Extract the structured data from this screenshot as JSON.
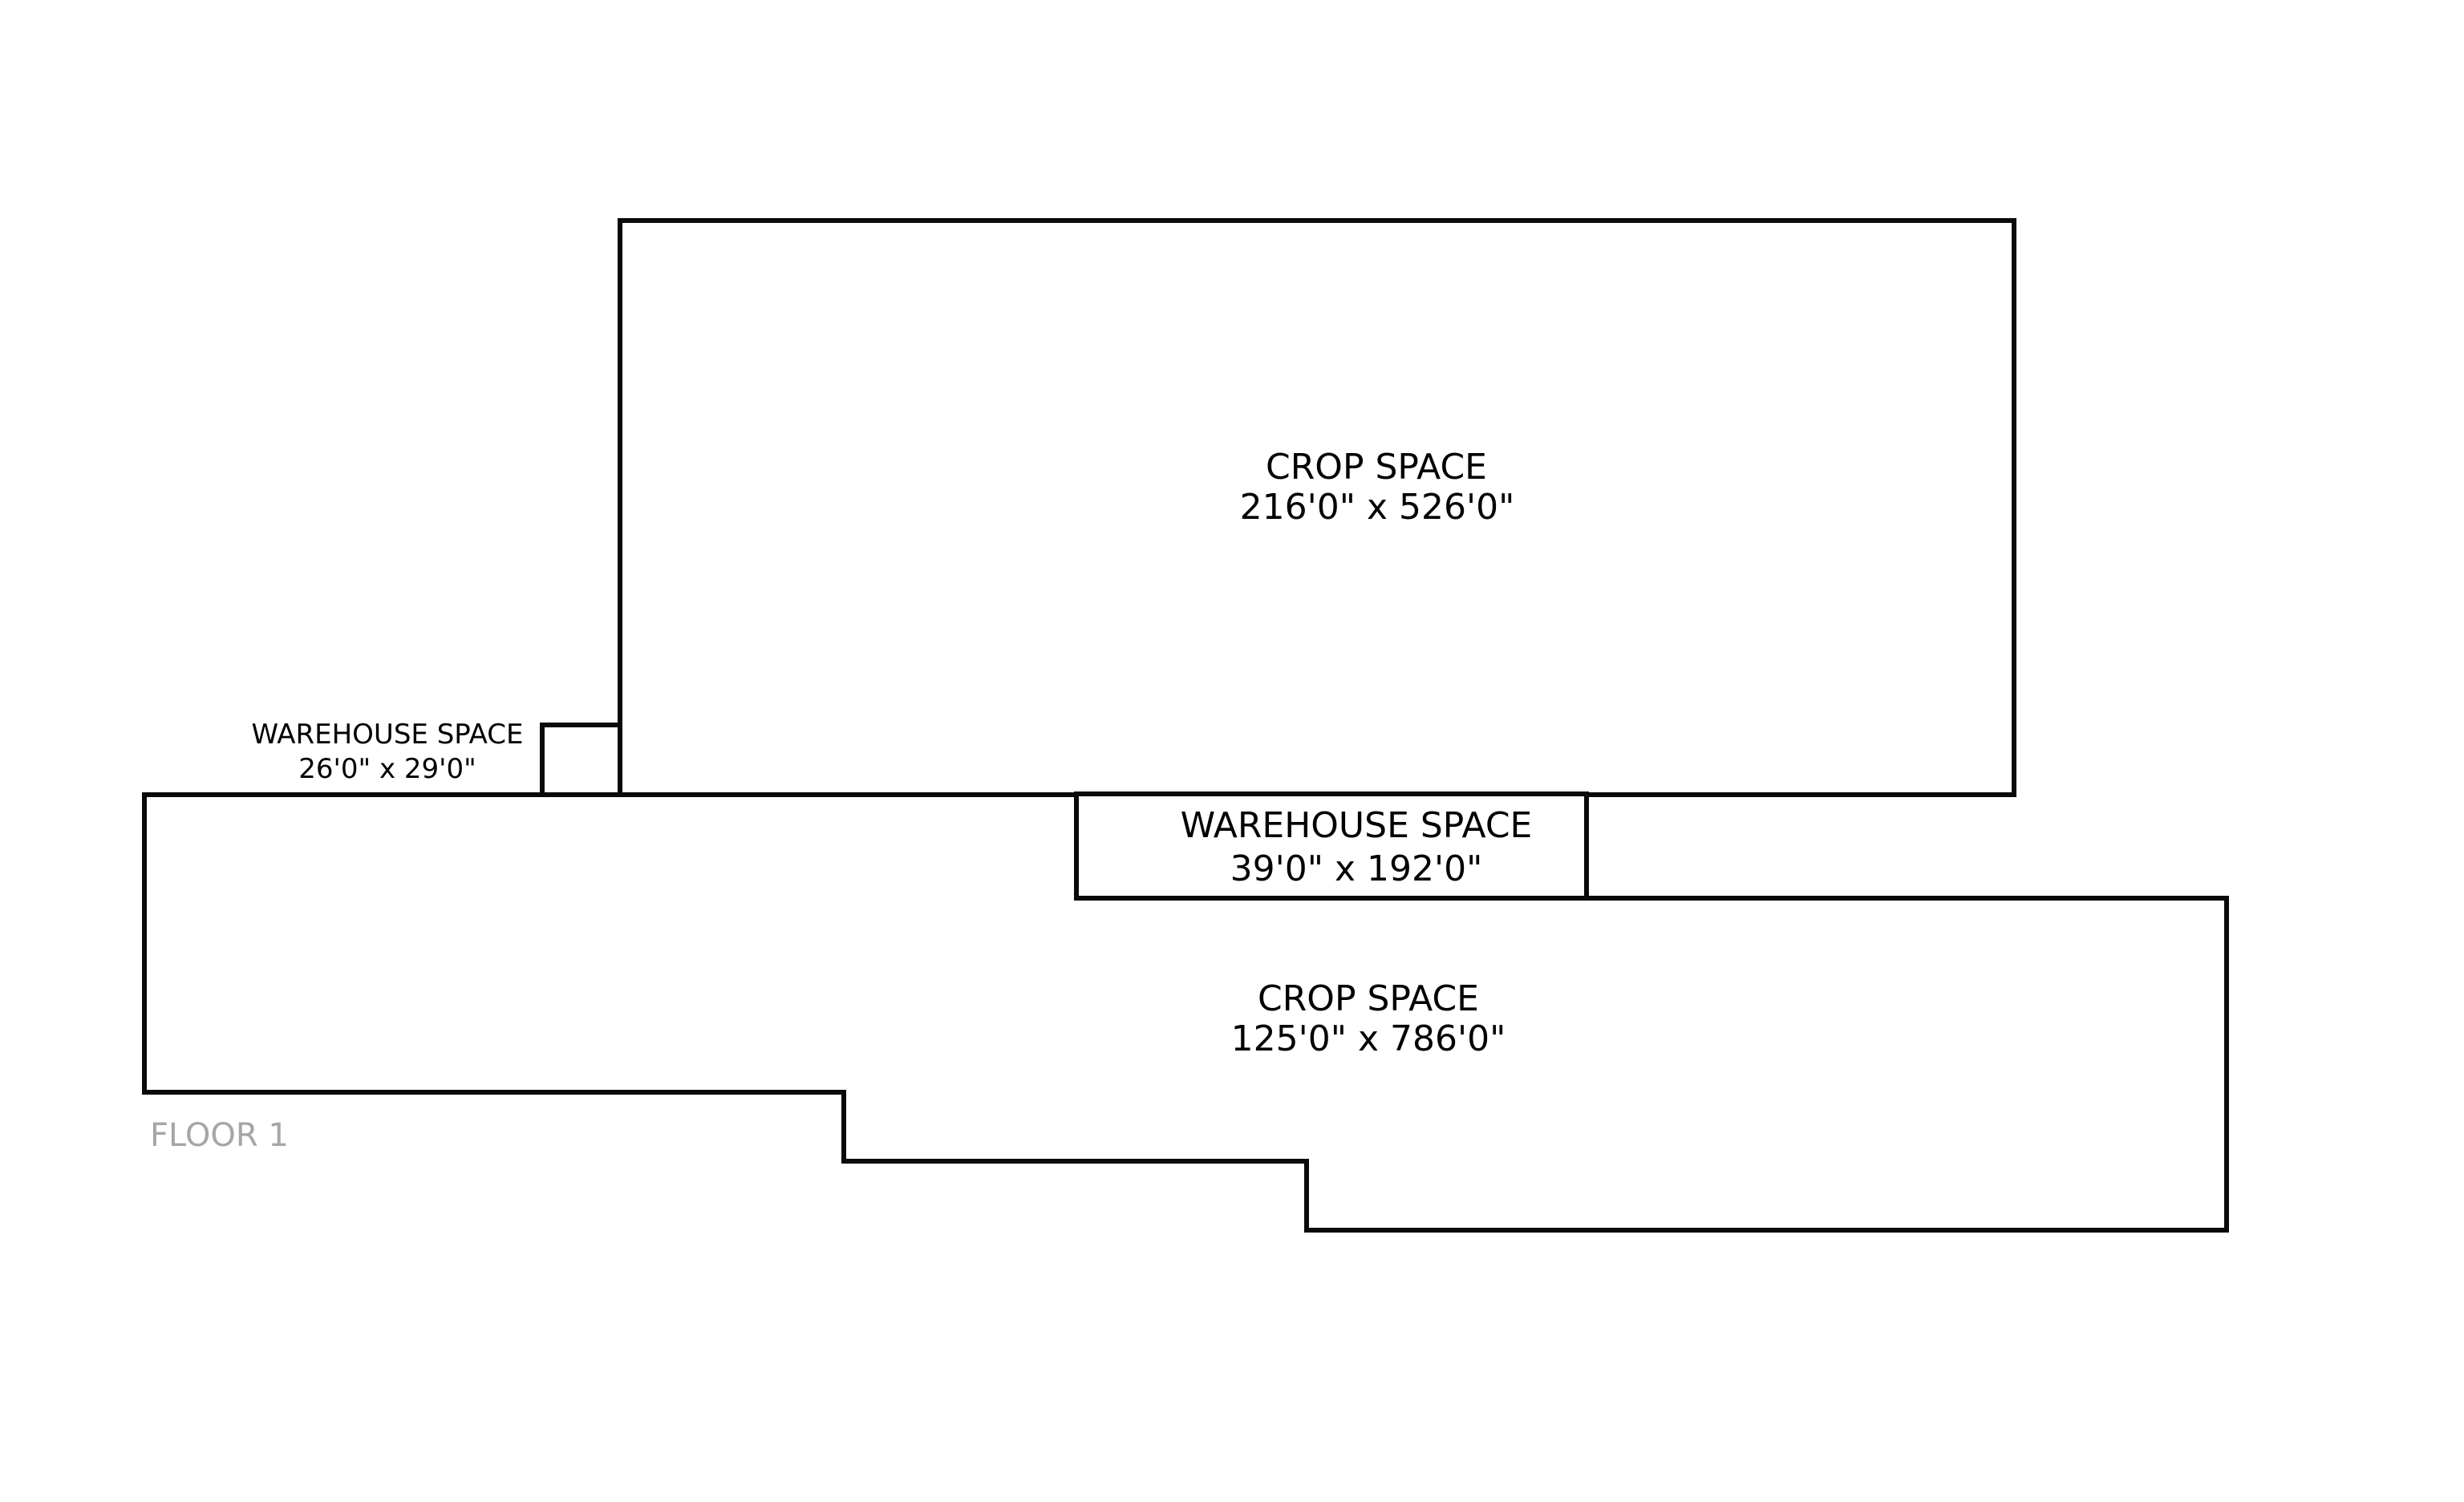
{
  "floor_plan": {
    "floor_label": "FLOOR 1",
    "rooms": [
      {
        "id": "crop-space-top",
        "name": "CROP SPACE",
        "dims": "216'0\" x 526'0\""
      },
      {
        "id": "warehouse-small",
        "name": "WAREHOUSE SPACE",
        "dims": "26'0\" x 29'0\""
      },
      {
        "id": "warehouse-mid",
        "name": "WAREHOUSE SPACE",
        "dims": "39'0\" x 192'0\""
      },
      {
        "id": "crop-space-bottom",
        "name": "CROP SPACE",
        "dims": "125'0\" x 786'0\""
      }
    ],
    "colors": {
      "wall": "#0a0a0a",
      "label": "#000000",
      "floor_label": "#a6a6a6",
      "background": "#ffffff"
    }
  }
}
